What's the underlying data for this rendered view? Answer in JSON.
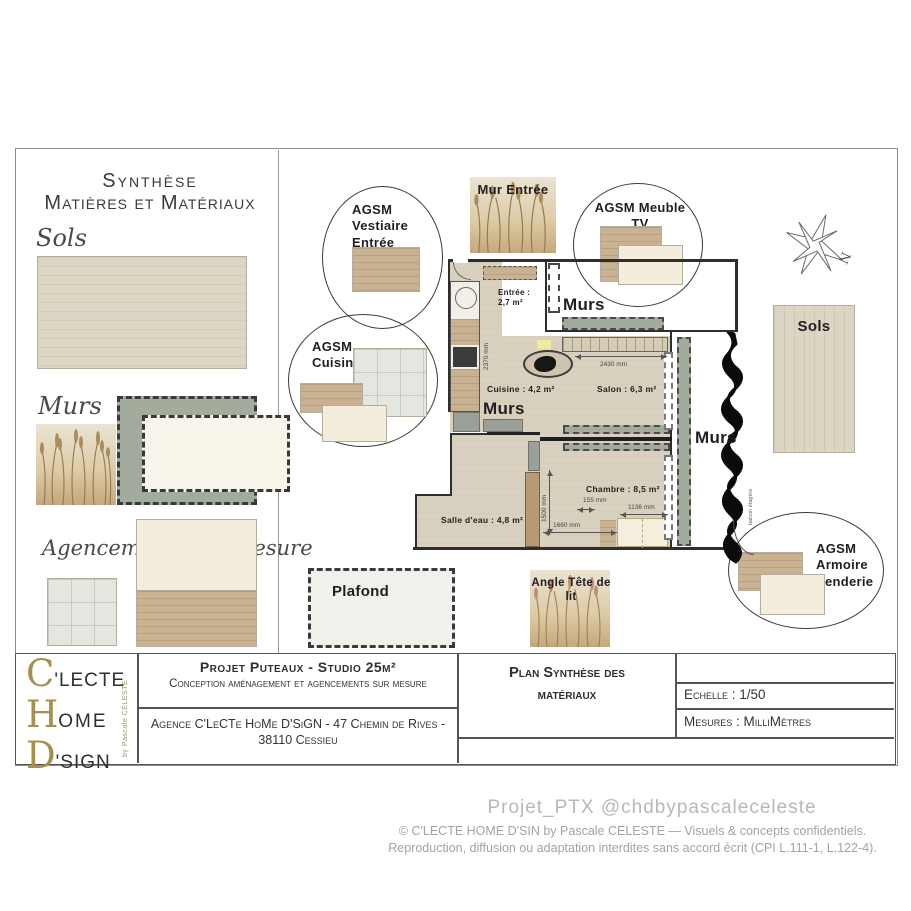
{
  "left_panel": {
    "title1": "Synthèse",
    "title2": "Matières et Matériaux",
    "sols_label": "Sols",
    "murs_label": "Murs",
    "agencements_label": "Agencements sur mesure"
  },
  "callouts": {
    "vestiaire": "AGSM\nVestiaire\nEntrée",
    "cuisine": "AGSM\nCuisine",
    "meuble_tv": "AGSM Meuble TV",
    "armoire": "AGSM\nArmoire\nPenderie"
  },
  "plan": {
    "mur_entree_label": "Mur Entrée",
    "sols_right_label": "Sols",
    "plafond_label": "Plafond",
    "angle_tete_label": "Angle Tête de lit",
    "murs_top": "Murs",
    "murs_left": "Murs",
    "murs_right": "Murs",
    "compass_n": "N",
    "hedge_note": "balcon étagère",
    "rooms": {
      "entree": "Entrée :\n2,7 m²",
      "cuisine": "Cuisine : 4,2 m²",
      "salon": "Salon : 6,3 m²",
      "chambre": "Chambre : 8,5 m²",
      "salle_eau": "Salle d'eau : 4,8 m²"
    },
    "dims": {
      "d2370": "2370 mm",
      "d2430": "2430 mm",
      "d1500": "1500 mm",
      "d155": "155 mm",
      "d1136": "1136 mm",
      "d1660": "1660 mm"
    }
  },
  "title_block": {
    "logo": {
      "l1_big": "C",
      "l1_rest": "'LECTE",
      "l2_big": "H",
      "l2_rest": "OME",
      "l3_big": "D",
      "l3_rest": "'SIGN",
      "byline": "by Pascale CÉLESTE"
    },
    "project_title": "Projet Puteaux - Studio 25m²",
    "project_subtitle": "Conception aménagement et agencements sur mesure",
    "agency": "Agence C'LeCTe HoMe D'SiGN - 47 Chemin de Rives - 38110 Cessieu",
    "plan_title": "Plan Synthèse des\nmatériaux",
    "scale": "Echelle : 1/50",
    "units": "Mesures : MilliMètres"
  },
  "footer": {
    "handle": "Projet_PTX @chdbypascaleceleste",
    "copyright1": "© C'LECTE HOME D'SIN by Pascale CELESTE — Visuels & concepts confidentiels.",
    "copyright2": "Reproduction, diffusion ou adaptation interdites sans accord écrit (CPI L.111-1, L.122-4)."
  },
  "colors": {
    "gold": "#a5914c",
    "sage": "#a2ab9c",
    "wall": "#2e2e2e"
  }
}
